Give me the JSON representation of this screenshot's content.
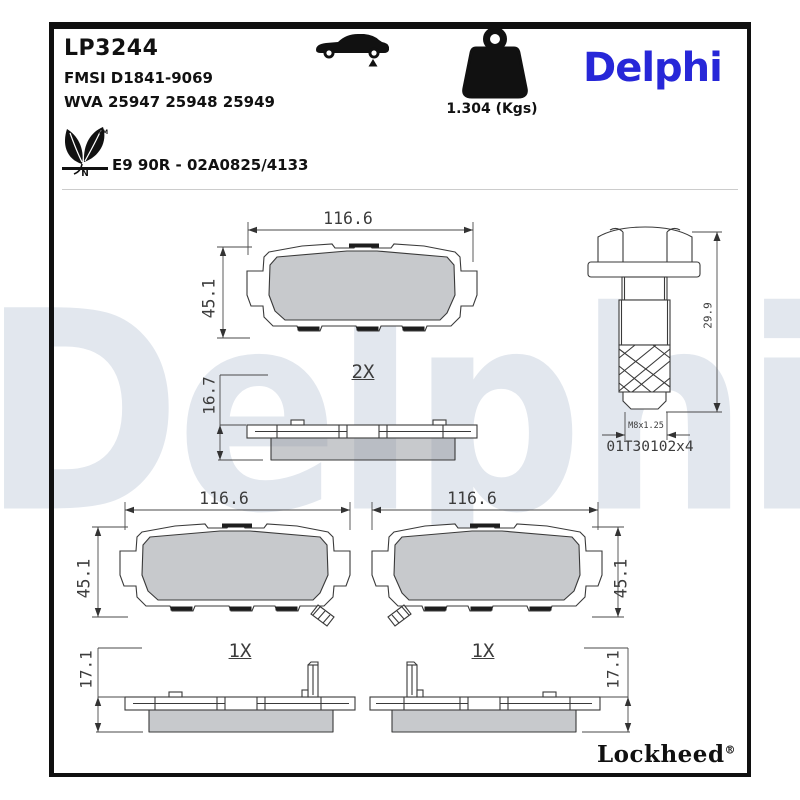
{
  "header": {
    "part_number": "LP3244",
    "fmsi": "FMSI D1841-9069",
    "wva": "WVA 25947 25948 25949",
    "weight_label": "1.304 (Kgs)",
    "brand": "Delphi",
    "approval": "E9 90R - 02A0825/4133",
    "eco": {
      "tm": "TM",
      "n": "N"
    }
  },
  "watermark": "Delphi",
  "drawings": {
    "top_pair": {
      "width": "116.6",
      "height": "45.1",
      "thickness": "16.7",
      "qty": "2X"
    },
    "bolt": {
      "length": "29.9",
      "thread": "M8x1.25",
      "part": "01T30102x4"
    },
    "bottom_left": {
      "width": "116.6",
      "height": "45.1",
      "thickness": "17.1",
      "qty": "1X"
    },
    "bottom_right": {
      "width": "116.6",
      "height": "45.1",
      "thickness": "17.1",
      "qty": "1X"
    }
  },
  "footer": {
    "brand": "Lockheed",
    "reg": "®"
  },
  "colors": {
    "brand_blue": "#2727d8",
    "watermark_gray_blue": "#e2e7ee",
    "friction_gray": "#c9c9c9",
    "line_gray": "#3a3a3a"
  }
}
